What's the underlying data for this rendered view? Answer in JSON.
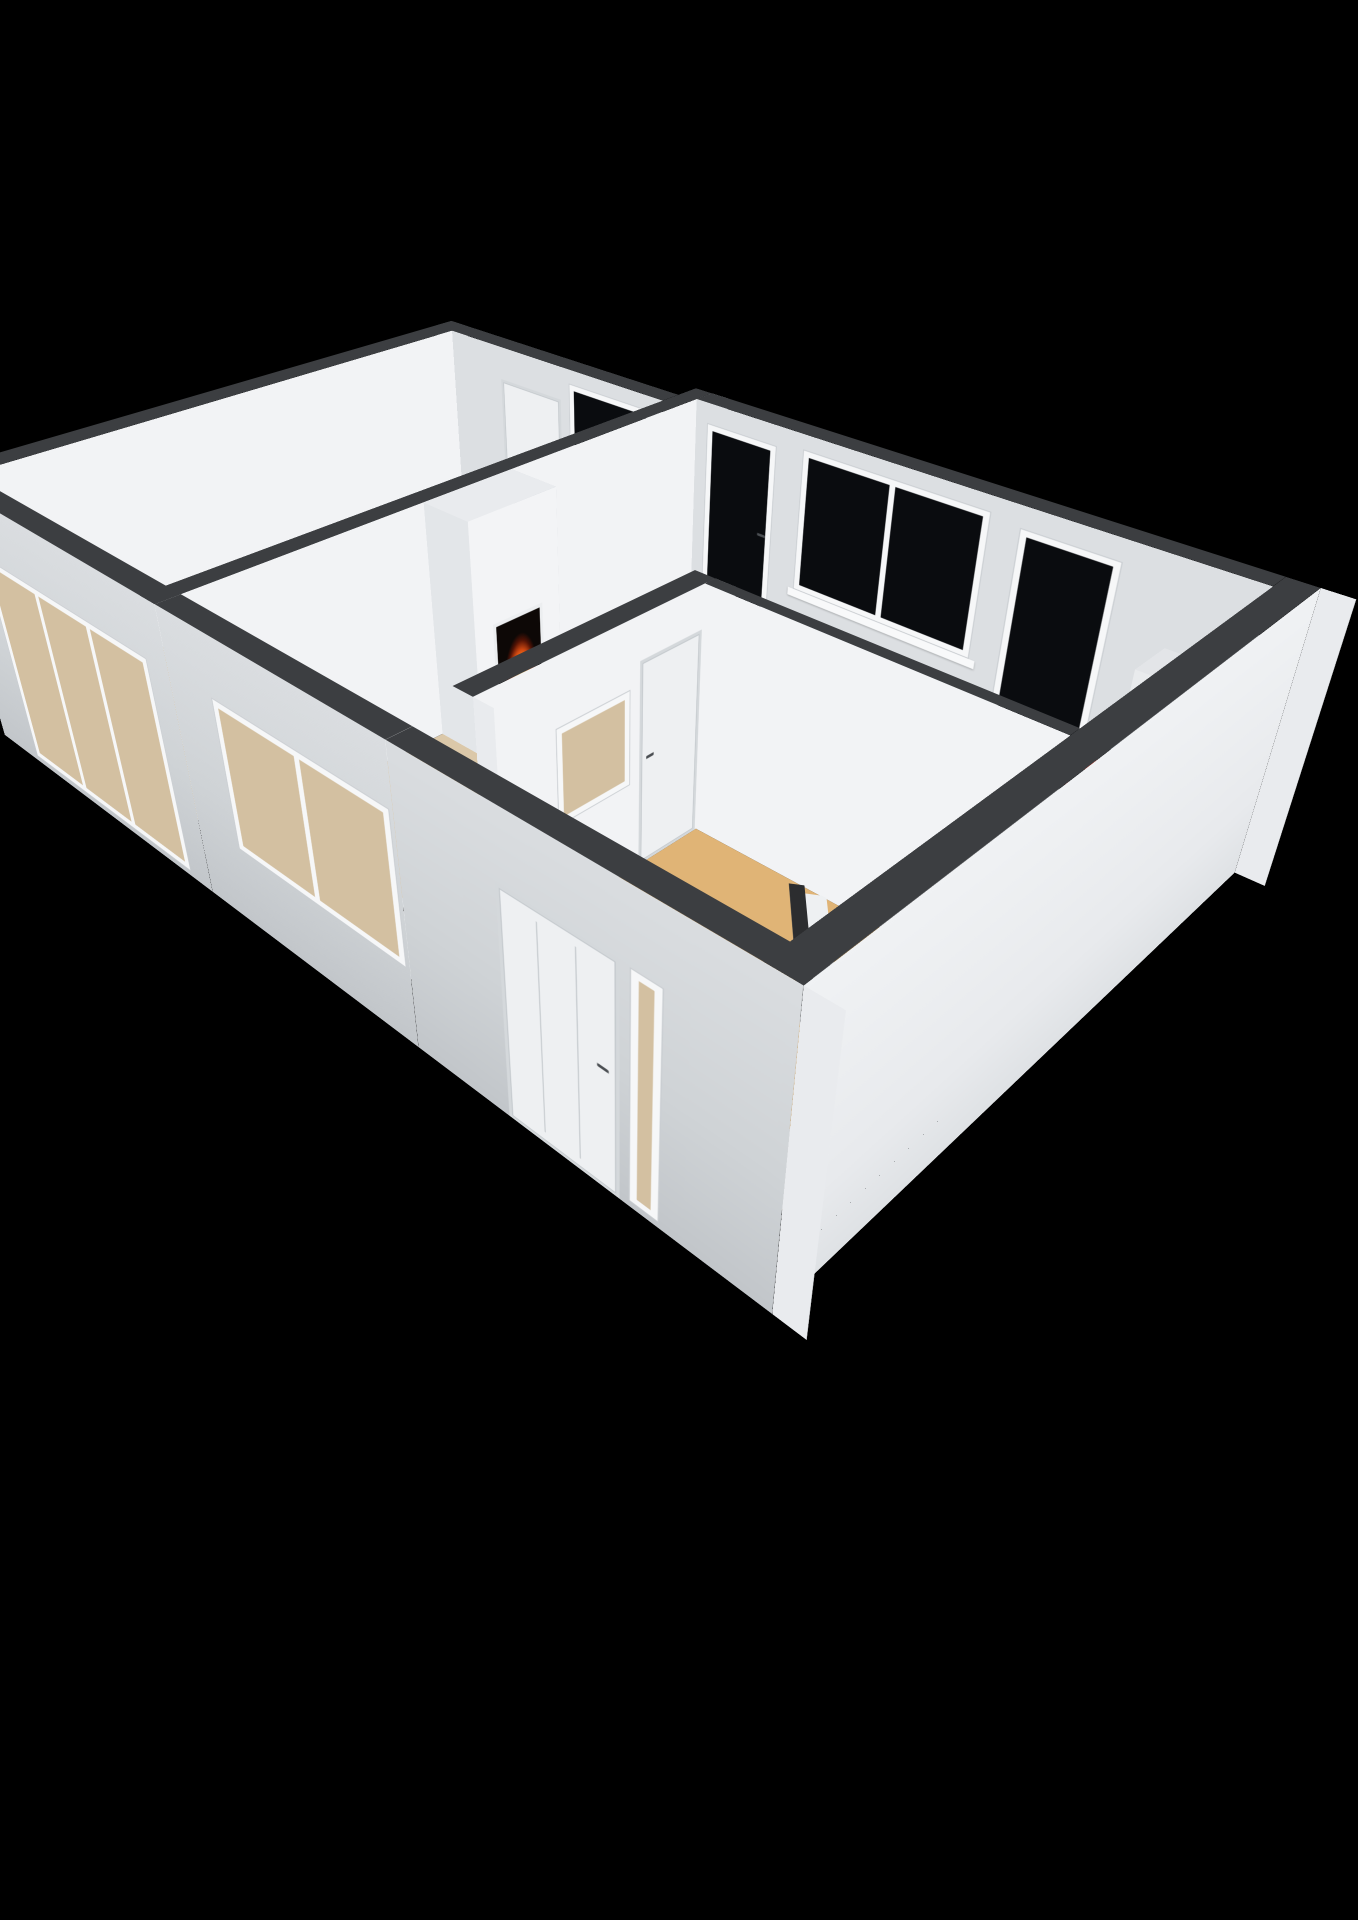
{
  "canvas": {
    "width": 1358,
    "height": 1920,
    "background": "#000000"
  },
  "palette": {
    "wallTop": "#3c3e41",
    "intBright": "#f2f3f5",
    "intGray": "#dcdfe2",
    "extSW": "linear-gradient(180deg,#dadde0 0%,#cfd3d6 55%,#c2c6ca 100%)",
    "extSE": "linear-gradient(180deg,#f0f2f4 0%,#e8eaed 70%,#dfe2e5 100%)",
    "capWhite": "#e9ebee",
    "frame": "#f6f7f8",
    "sill": "#f8f9fa",
    "glassDark": "#0a0c0f",
    "glassThrough": "#d3c0a1",
    "floorBedroom": "#d9c6a7",
    "floorLiving": "#dbc8a9",
    "floorHall": "#e0b476",
    "floorTile": "#d6d8da",
    "counterTop": "#c3ceda",
    "cooktopBlack": "#141619",
    "burnerRed": "#d62d17",
    "fireOrange": "#ff8f1f",
    "railDark": "#2c2d2f",
    "doorLeaf": "#eef0f2",
    "handleDark": "#4a4e52"
  },
  "scene": {
    "camera": {
      "perspective": 1500,
      "originX": 620,
      "originY": 840,
      "tx": 30,
      "ty": 700,
      "rotX": 54,
      "rotZ": -46,
      "sx": 0.9,
      "sy": 1.08,
      "sz": 0.95
    },
    "floors": [
      {
        "name": "bedroom-floor",
        "x": 0,
        "y": 0,
        "w": 640,
        "d": 300,
        "z": 0,
        "fill": "floorBedroom"
      },
      {
        "name": "living-room-floor",
        "x": 0,
        "y": 320,
        "w": 670,
        "d": 240,
        "z": 0,
        "fill": "floorLiving"
      },
      {
        "name": "kitchen-floor",
        "x": 344,
        "y": 560,
        "w": 326,
        "d": 320,
        "z": 0,
        "fill": "floorLiving"
      },
      {
        "name": "living-opening-floor",
        "x": 0,
        "y": 560,
        "w": 60,
        "d": 20,
        "z": 0,
        "fill": "floorLiving"
      },
      {
        "name": "hall-floor",
        "x": 0,
        "y": 580,
        "w": 330,
        "d": 300,
        "z": 0.3,
        "fill": "floorHall"
      },
      {
        "name": "hall-tile-floor",
        "x": 0,
        "y": 796,
        "w": 112,
        "d": 84,
        "z": 0.6,
        "fill": "floorTile"
      }
    ],
    "flats": [
      {
        "name": "staircase-lower-flight",
        "x": 84,
        "y": 742,
        "len": 246,
        "w": 138,
        "angle": 0,
        "z": 0.8,
        "fill": "linear-gradient(125deg,#bf904d 0%,#d2a562 55%,#ddb172 100%)"
      },
      {
        "name": "stair-stringer",
        "x": 332,
        "y": 712,
        "len": 298,
        "w": 30,
        "angle": 143.5,
        "z": 1.4,
        "fill": "#eef0f2"
      },
      {
        "name": "stair-railing",
        "x": 330,
        "y": 692,
        "len": 308,
        "w": 13,
        "angle": 143.5,
        "z": 2.2,
        "fill": "railDark"
      }
    ],
    "walls": [
      {
        "name": "bedroom-nw-wall",
        "x1": -26,
        "y1": 0,
        "x2": 666,
        "y2": 0,
        "t": 26,
        "h": 250,
        "zb": 0,
        "face": "intBright",
        "features": []
      },
      {
        "name": "bedroom-ne-wall",
        "x1": 640,
        "y1": -26,
        "x2": 640,
        "y2": 300,
        "t": 26,
        "h": 250,
        "zb": 0,
        "face": "intGray",
        "features": [
          {
            "type": "door",
            "name": "bedroom-door",
            "x": 100,
            "w": 88,
            "h": 212,
            "handle": "right"
          },
          {
            "type": "window",
            "name": "bedroom-window",
            "x": 200,
            "w": 112,
            "z": 78,
            "h": 156,
            "glass": "dark",
            "sill": true
          }
        ]
      },
      {
        "name": "room-divider-wall",
        "x1": -26,
        "y1": 320,
        "x2": 696,
        "y2": 320,
        "t": 20,
        "h": 250,
        "zb": 0,
        "face": "intBright",
        "caps": true,
        "features": []
      },
      {
        "name": "living-ne-wall",
        "x1": 670,
        "y1": 320,
        "x2": 670,
        "y2": 880,
        "t": 26,
        "h": 250,
        "zb": 0,
        "face": "intGray",
        "features": [
          {
            "type": "window",
            "name": "living-glazed-door-1",
            "x": 14,
            "w": 84,
            "z": 6,
            "h": 222,
            "glass": "dark",
            "handle": "right"
          },
          {
            "type": "window",
            "name": "living-double-window",
            "x": 128,
            "w": 196,
            "z": 78,
            "h": 156,
            "glass": "dark",
            "mullions": 1,
            "sill": true
          },
          {
            "type": "window",
            "name": "living-glazed-door-2",
            "x": 352,
            "w": 92,
            "z": 6,
            "h": 222,
            "glass": "dark"
          }
        ]
      },
      {
        "name": "living-sw-wall",
        "x1": -26,
        "y1": 320,
        "x2": -26,
        "y2": 580,
        "t": 26,
        "h": 295,
        "zb": -45,
        "face": "extSW",
        "features": [
          {
            "type": "window",
            "name": "living-sw-window",
            "x": 56,
            "w": 200,
            "z": 82,
            "h": 152,
            "glass": "through",
            "mullions": 1
          }
        ]
      },
      {
        "name": "bedroom-sw-wall",
        "x1": -26,
        "y1": -26,
        "x2": -26,
        "y2": 320,
        "t": 26,
        "h": 295,
        "zb": -45,
        "face": "extSW",
        "features": [
          {
            "type": "window",
            "name": "bedroom-slider-window",
            "x": 64,
            "w": 252,
            "z": 6,
            "h": 226,
            "glass": "through",
            "mullions": 2
          }
        ]
      },
      {
        "name": "hall-nw-wall",
        "x1": 60,
        "y1": 580,
        "x2": 344,
        "y2": 580,
        "t": 20,
        "h": 250,
        "zb": 0,
        "face": "intBright",
        "caps": true,
        "features": [
          {
            "type": "window",
            "name": "hall-interior-window",
            "x": 86,
            "w": 90,
            "z": 92,
            "h": 94,
            "glass": "through"
          },
          {
            "type": "door",
            "name": "hall-door",
            "x": 188,
            "w": 80,
            "h": 208,
            "handle": "left"
          }
        ]
      },
      {
        "name": "hall-ne-wall",
        "x1": 330,
        "y1": 580,
        "x2": 330,
        "y2": 880,
        "t": 14,
        "h": 250,
        "zb": 0,
        "face": "intBright",
        "features": []
      },
      {
        "name": "hall-sw-wall",
        "x1": -26,
        "y1": 580,
        "x2": -26,
        "y2": 906,
        "t": 26,
        "h": 295,
        "zb": -45,
        "face": "extSW",
        "features": [
          {
            "type": "door",
            "name": "entry-door",
            "x": 96,
            "w": 104,
            "h": 228,
            "handle": "right",
            "entry": true
          },
          {
            "type": "window",
            "name": "entry-sidelight",
            "x": 208,
            "w": 26,
            "z": 6,
            "h": 222,
            "glass": "through"
          }
        ]
      },
      {
        "name": "south-wall",
        "x1": -26,
        "y1": 906,
        "x2": 696,
        "y2": 906,
        "t": 26,
        "h": 295,
        "zb": -45,
        "face": "extSE",
        "caps": true,
        "features": []
      }
    ],
    "boxes": [
      {
        "name": "fireplace",
        "x": 272,
        "y": 320,
        "w": 116,
        "d": 54,
        "zb": 0,
        "h": 250,
        "top": "#e9ebee",
        "front": "#f3f4f6",
        "west": "#e3e6e9",
        "east": "#dde0e4",
        "north": "#eceef0",
        "features": [
          {
            "type": "fire",
            "name": "fireplace-fire",
            "x": 24,
            "w": 68,
            "z": 34,
            "h": 104
          }
        ]
      },
      {
        "name": "kitchen-counter",
        "x": 380,
        "y": 810,
        "w": 290,
        "d": 70,
        "zb": 0,
        "h": 90,
        "top": "counterTop",
        "front": "#dfe3e7",
        "west": "#edeff1",
        "east": "#dfe3e7",
        "north": "#d8dde2"
      },
      {
        "name": "kitchen-counter-return",
        "x": 344,
        "y": 600,
        "w": 64,
        "d": 210,
        "zb": 0,
        "h": 90,
        "top": "counterTop",
        "front": "#dfe3e7",
        "west": "#e8eaec",
        "east": "#d8dde2",
        "north": "#d8dde2"
      },
      {
        "name": "cooktop",
        "x": 468,
        "y": 812,
        "w": 112,
        "d": 66,
        "zb": 90,
        "h": 9,
        "top": "cooktopBlack",
        "front": "#222427",
        "west": "#1c1e21",
        "east": "#222427",
        "north": "#222427",
        "burners": true
      },
      {
        "name": "kitchen-appliance",
        "x": 612,
        "y": 813,
        "w": 56,
        "d": 64,
        "zb": 90,
        "h": 74,
        "top": "#e3e5e8",
        "front": "#eff1f3",
        "west": "#e9ebed",
        "east": "#e6e8ea",
        "north": "#e6e8ea"
      },
      {
        "name": "hall-niche",
        "x": -6,
        "y": 536,
        "w": 64,
        "d": 44,
        "zb": 0,
        "h": 62,
        "top": "#eff1f3",
        "front": "#f2f4f6",
        "west": "#e6e8ea",
        "east": "#eceef0",
        "north": "#eceef0",
        "slot": true
      }
    ]
  }
}
